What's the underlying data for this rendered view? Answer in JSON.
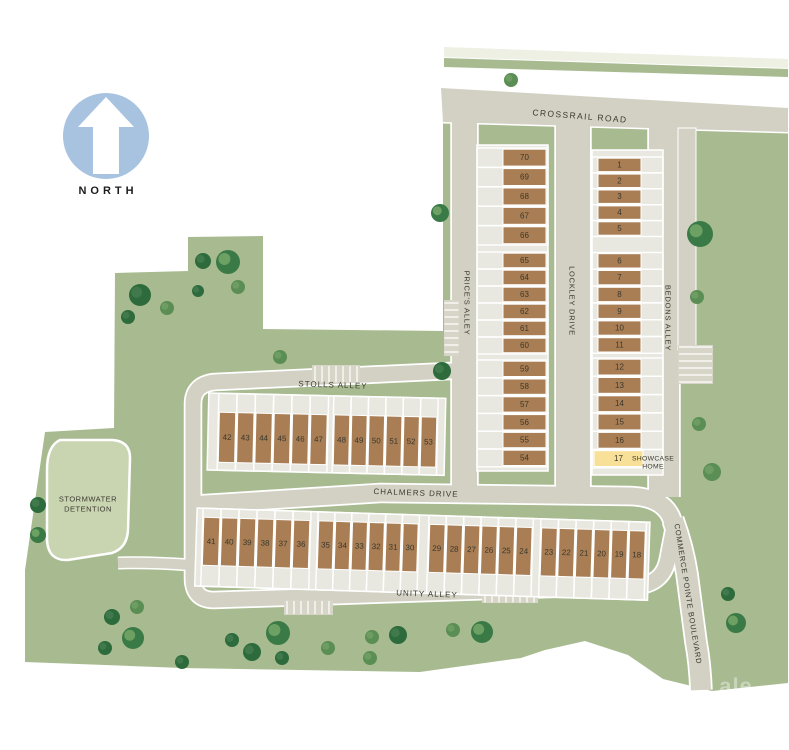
{
  "page": {
    "type": "community site plan",
    "width": 789,
    "height": 750
  },
  "compass": {
    "label": "NORTH"
  },
  "streets": {
    "crossrail": "CROSSRAIL ROAD",
    "prices": "PRICE'S ALLEY",
    "lockley": "LOCKLEY DRIVE",
    "bedons": "BEDONS ALLEY",
    "stolls": "STOLLS ALLEY",
    "chalmers": "CHALMERS DRIVE",
    "unity": "UNITY ALLEY",
    "commerce": "COMMERCE POINTE BOULEVARD"
  },
  "areas": {
    "stormwater_line1": "STORMWATER",
    "stormwater_line2": "DETENTION"
  },
  "showcase": {
    "lot": 17,
    "line1": "SHOWCASE",
    "line2": "HOME"
  },
  "watermark": {
    "text": "ale"
  },
  "colors": {
    "site_green": "#a8bb90",
    "road_gray": "#d3d1c4",
    "lot_brown": "#a97e54",
    "showcase_yellow": "#f8e098",
    "pond_green": "#c9d4b1",
    "strip_light": "#e9e8e0",
    "north_blue": "#a7c3df",
    "tree_dark": "#2d6b3c",
    "tree_medium": "#5b8e54",
    "tree_textured": "#3a7a46"
  },
  "lots": {
    "columns": [
      {
        "name": "west-column",
        "cell_x": 477,
        "cell_w": 71,
        "x": 503,
        "w": 43,
        "groups": [
          {
            "y": 148,
            "lot_h": 19.4,
            "lots": [
              70,
              69,
              68,
              67,
              66
            ]
          },
          {
            "y": 252,
            "lot_h": 17.0,
            "lots": [
              65,
              64,
              63,
              62,
              61,
              60
            ]
          },
          {
            "y": 360,
            "lot_h": 17.8,
            "lots": [
              59,
              58,
              57,
              56,
              55,
              54
            ]
          }
        ]
      },
      {
        "name": "east-column",
        "cell_x": 592,
        "cell_w": 71,
        "x": 598,
        "w": 43,
        "groups": [
          {
            "y": 157,
            "lot_h": 15.9,
            "lots": [
              1,
              2,
              3,
              4,
              5
            ]
          },
          {
            "y": 252.5,
            "lot_h": 16.8,
            "lots": [
              6,
              7,
              8,
              9,
              10,
              11
            ]
          },
          {
            "y": 358,
            "lot_h": 18.3,
            "lots": [
              12,
              13,
              14,
              15,
              16,
              17
            ]
          }
        ]
      }
    ],
    "rows": [
      {
        "name": "stolls-row",
        "target": "row-stolls",
        "cell_y": 393,
        "cell_h": 77,
        "y": 412,
        "h": 50,
        "groups": [
          {
            "x": 218,
            "lot_w": 18.3,
            "lots": [
              42,
              43,
              44,
              45,
              46,
              47
            ]
          },
          {
            "x": 333,
            "lot_w": 17.4,
            "lots": [
              48,
              49,
              50,
              51,
              52,
              53
            ]
          }
        ]
      },
      {
        "name": "chalmers-row",
        "target": "row-chalmers",
        "cell_y": 508,
        "cell_h": 78,
        "y": 517,
        "h": 48,
        "groups": [
          {
            "x": 202,
            "lot_w": 18.0,
            "lots": [
              41,
              40,
              39,
              38,
              37,
              36
            ]
          },
          {
            "x": 317,
            "lot_w": 16.9,
            "lots": [
              35,
              34,
              33,
              32,
              31,
              30
            ]
          },
          {
            "x": 428,
            "lot_w": 17.4,
            "lots": [
              29,
              28,
              27,
              26,
              25,
              24
            ]
          },
          {
            "x": 540,
            "lot_w": 17.6,
            "lots": [
              23,
              22,
              21,
              20,
              19,
              18
            ]
          }
        ]
      }
    ]
  },
  "trees": [
    [
      511,
      80,
      7,
      "m"
    ],
    [
      700,
      234,
      13,
      "T"
    ],
    [
      697,
      297,
      7,
      "m"
    ],
    [
      699,
      424,
      7,
      "m"
    ],
    [
      712,
      472,
      9,
      "m"
    ],
    [
      728,
      594,
      7,
      "d"
    ],
    [
      736,
      623,
      10,
      "T"
    ],
    [
      140,
      295,
      11,
      "d"
    ],
    [
      128,
      317,
      7,
      "d"
    ],
    [
      167,
      308,
      7,
      "m"
    ],
    [
      198,
      291,
      6,
      "d"
    ],
    [
      203,
      261,
      8,
      "d"
    ],
    [
      228,
      262,
      12,
      "T"
    ],
    [
      238,
      287,
      7,
      "m"
    ],
    [
      280,
      357,
      7,
      "m"
    ],
    [
      440,
      213,
      9,
      "T"
    ],
    [
      442,
      371,
      9,
      "d"
    ],
    [
      38,
      505,
      8,
      "d"
    ],
    [
      38,
      535,
      8,
      "T"
    ],
    [
      112,
      617,
      8,
      "d"
    ],
    [
      137,
      607,
      7,
      "m"
    ],
    [
      133,
      638,
      11,
      "T"
    ],
    [
      105,
      648,
      7,
      "d"
    ],
    [
      182,
      662,
      7,
      "d"
    ],
    [
      232,
      640,
      7,
      "d"
    ],
    [
      252,
      652,
      9,
      "d"
    ],
    [
      278,
      633,
      12,
      "T"
    ],
    [
      282,
      658,
      7,
      "d"
    ],
    [
      328,
      648,
      7,
      "m"
    ],
    [
      372,
      637,
      7,
      "m"
    ],
    [
      398,
      635,
      9,
      "d"
    ],
    [
      370,
      658,
      7,
      "m"
    ],
    [
      453,
      630,
      7,
      "m"
    ],
    [
      482,
      632,
      11,
      "T"
    ]
  ]
}
